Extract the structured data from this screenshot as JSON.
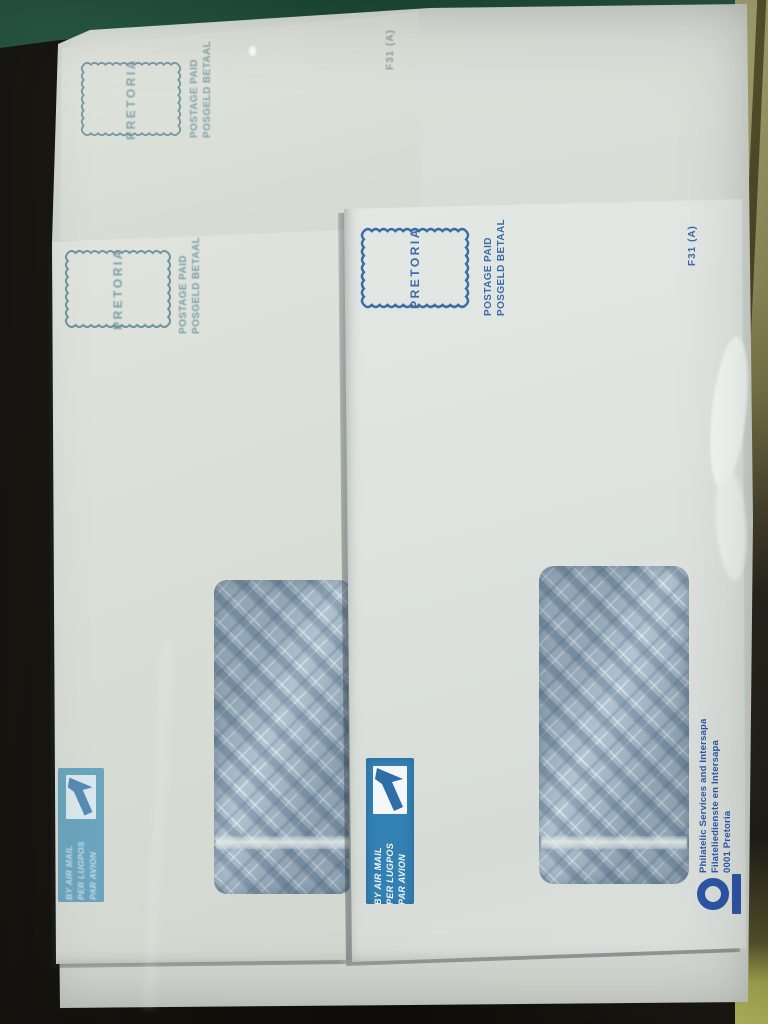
{
  "photo": {
    "colors": {
      "green_mat": "#23503e",
      "dark_surface": "#14120d",
      "binder_edge_olive": "#a09d68",
      "binder_edge_yellow": "#c3c465",
      "sleeve_white": "#d6dbd5",
      "paper_back_envelopes": "#d9ded6",
      "paper_front_envelope": "#dee3df",
      "ink_faded_teal": "#6f95a0",
      "ink_blue": "#3c6ca6",
      "airmail_label_blue_front": "#3380b3",
      "airmail_label_blue_middle": "#4e93b5",
      "imprint_blue": "#2d55a4",
      "window_pattern_base": "#a9bcca"
    }
  },
  "envelopes": {
    "back_top": {
      "stamp_city": "PRETORIA",
      "postage_line1": "POSTAGE PAID",
      "postage_line2": "POSGELD BETAAL",
      "form_code": "F31 (A)"
    },
    "back_middle": {
      "stamp_city": "PRETORIA",
      "postage_line1": "POSTAGE PAID",
      "postage_line2": "POSGELD BETAAL",
      "airmail": {
        "line1": "BY AIR MAIL",
        "line2": "PER LUGPOS",
        "line3": "PAR AVION"
      }
    },
    "front": {
      "stamp_city": "PRETORIA",
      "postage_line1": "POSTAGE PAID",
      "postage_line2": "POSGELD BETAAL",
      "form_code": "F31 (A)",
      "airmail": {
        "line1": "BY AIR MAIL",
        "line2": "PER LUGPOS",
        "line3": "PAR AVION"
      },
      "imprint": {
        "line1": "Philatelic Services and Intersapa",
        "line2": "Filateliedienste en Intersapa",
        "line3": "0001 Pretoria"
      }
    }
  }
}
